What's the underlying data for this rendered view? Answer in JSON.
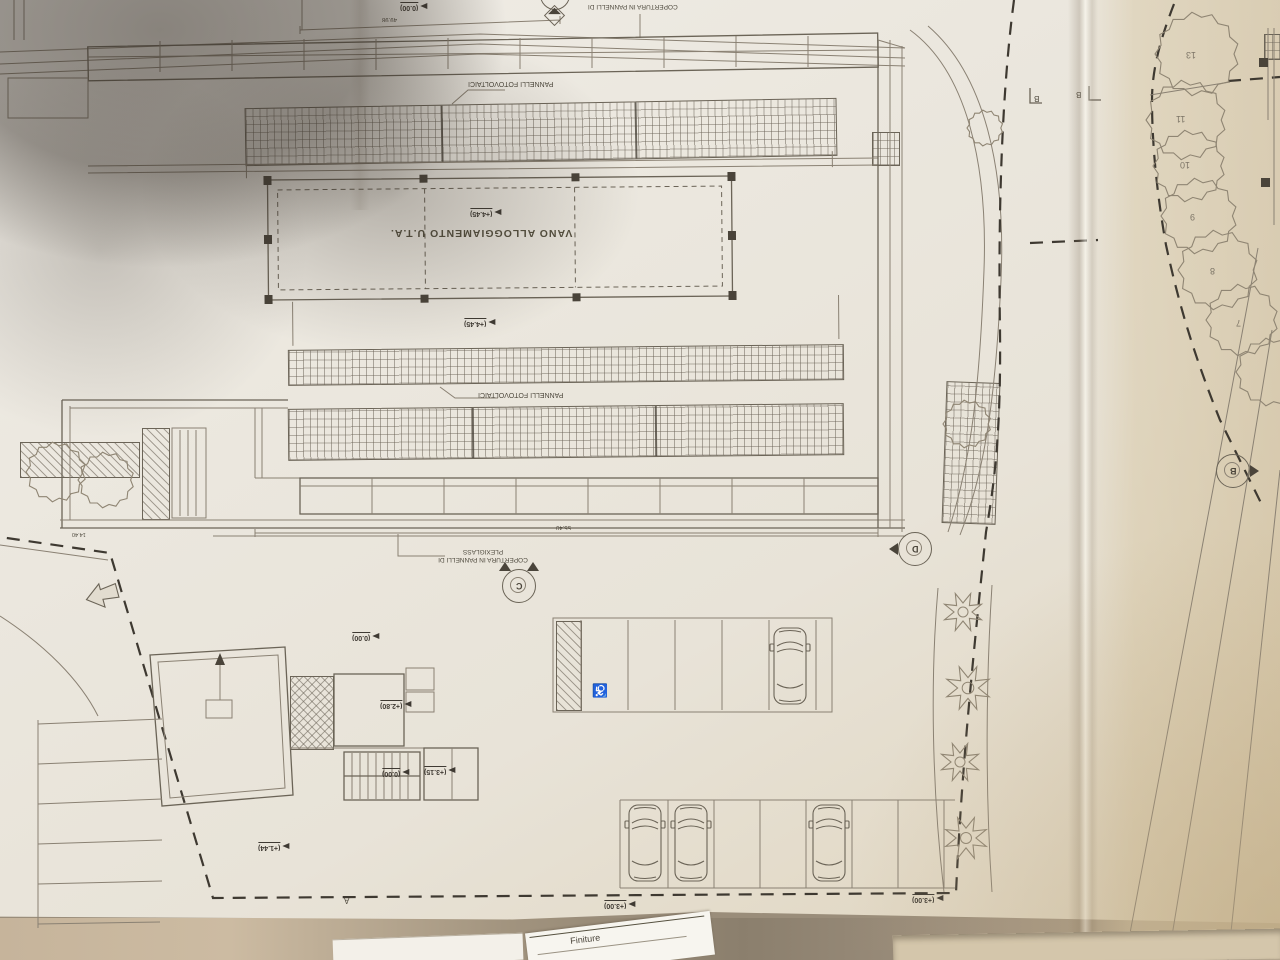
{
  "plan": {
    "labels": {
      "roof_top": "COPERTURA IN PANNELLI DI",
      "pv_label_1": "PANNELLI FOTOVOLTAICI",
      "pv_label_2": "PANNELLI FOTOVOLTAICI",
      "uta_room": "VANO ALLOGGIAMENTO U.T.A.",
      "plexiglass_line1": "COPERTURA IN PANNELLI DI",
      "plexiglass_line2": "PLEXIGLASS"
    },
    "dims": {
      "canopy": "55.40",
      "top": "49.98",
      "left": "14.40"
    },
    "levels": {
      "l1": "(0.00)",
      "l2": "(+4.45)",
      "l3": "(+4.45)",
      "l4": "(0.00)",
      "l5": "(+2.80)",
      "l6": "(0.00)",
      "l7": "(+3.15)",
      "l8": "(+1.44)",
      "l9": "(+3.00)",
      "l10": "(+3.00)"
    },
    "sections": {
      "c": "C",
      "d": "D",
      "b": "B",
      "b_top_left": "B",
      "b_top_right": "B",
      "a": "A"
    },
    "trees": [
      "13",
      "11",
      "10",
      "9",
      "8",
      "7"
    ],
    "symbols": {
      "wheelchair": "♿"
    }
  },
  "desk": {
    "snippet": "Finiture"
  },
  "colors": {
    "paper": "#ebe7de",
    "paper_warm": "#ddd0b4",
    "ink": "#6b6457",
    "ink_dark": "#3f3a33",
    "table": "#9a8d7a"
  }
}
